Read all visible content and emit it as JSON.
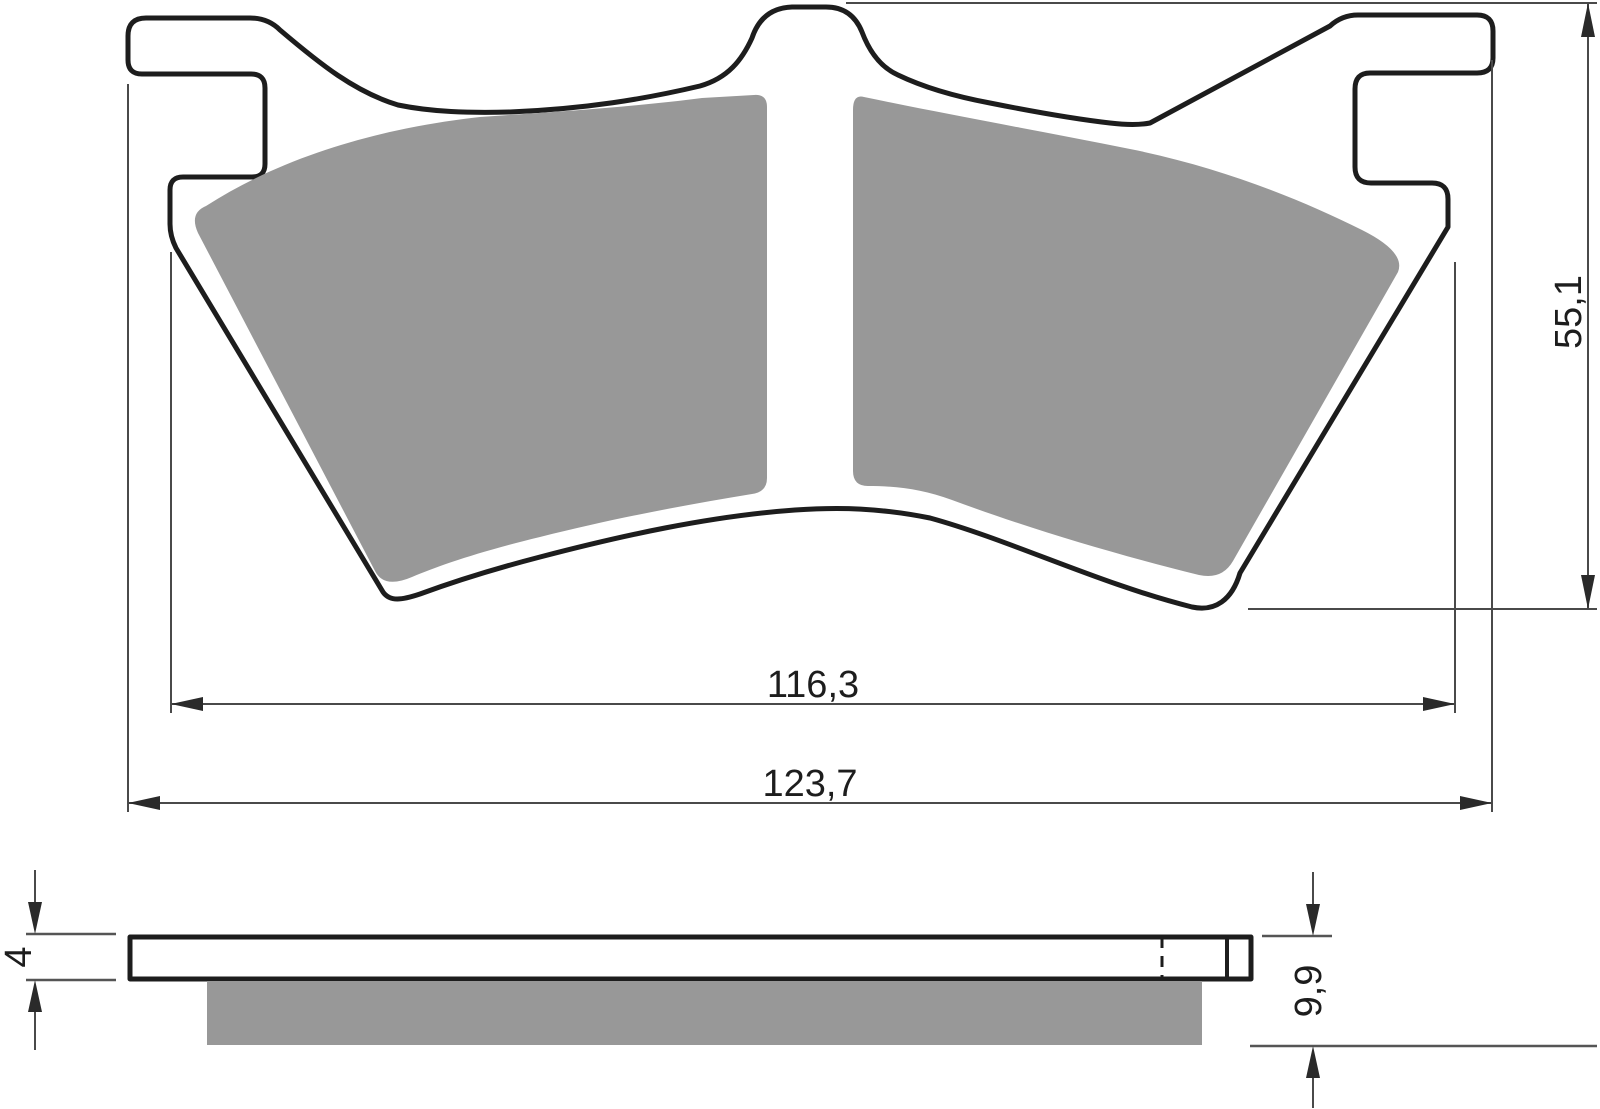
{
  "drawing": {
    "kind": "brake-pad-technical-drawing",
    "dimensions": {
      "pad_inner_width": "116,3",
      "pad_overall_width": "123,7",
      "pad_height": "55,1",
      "backplate_thickness": "4",
      "total_thickness": "9,9"
    },
    "colors": {
      "friction_material": "#989898",
      "outline": "#1d1d1d",
      "dimension_lines": "#4a4a4a",
      "background": "#ffffff"
    }
  }
}
